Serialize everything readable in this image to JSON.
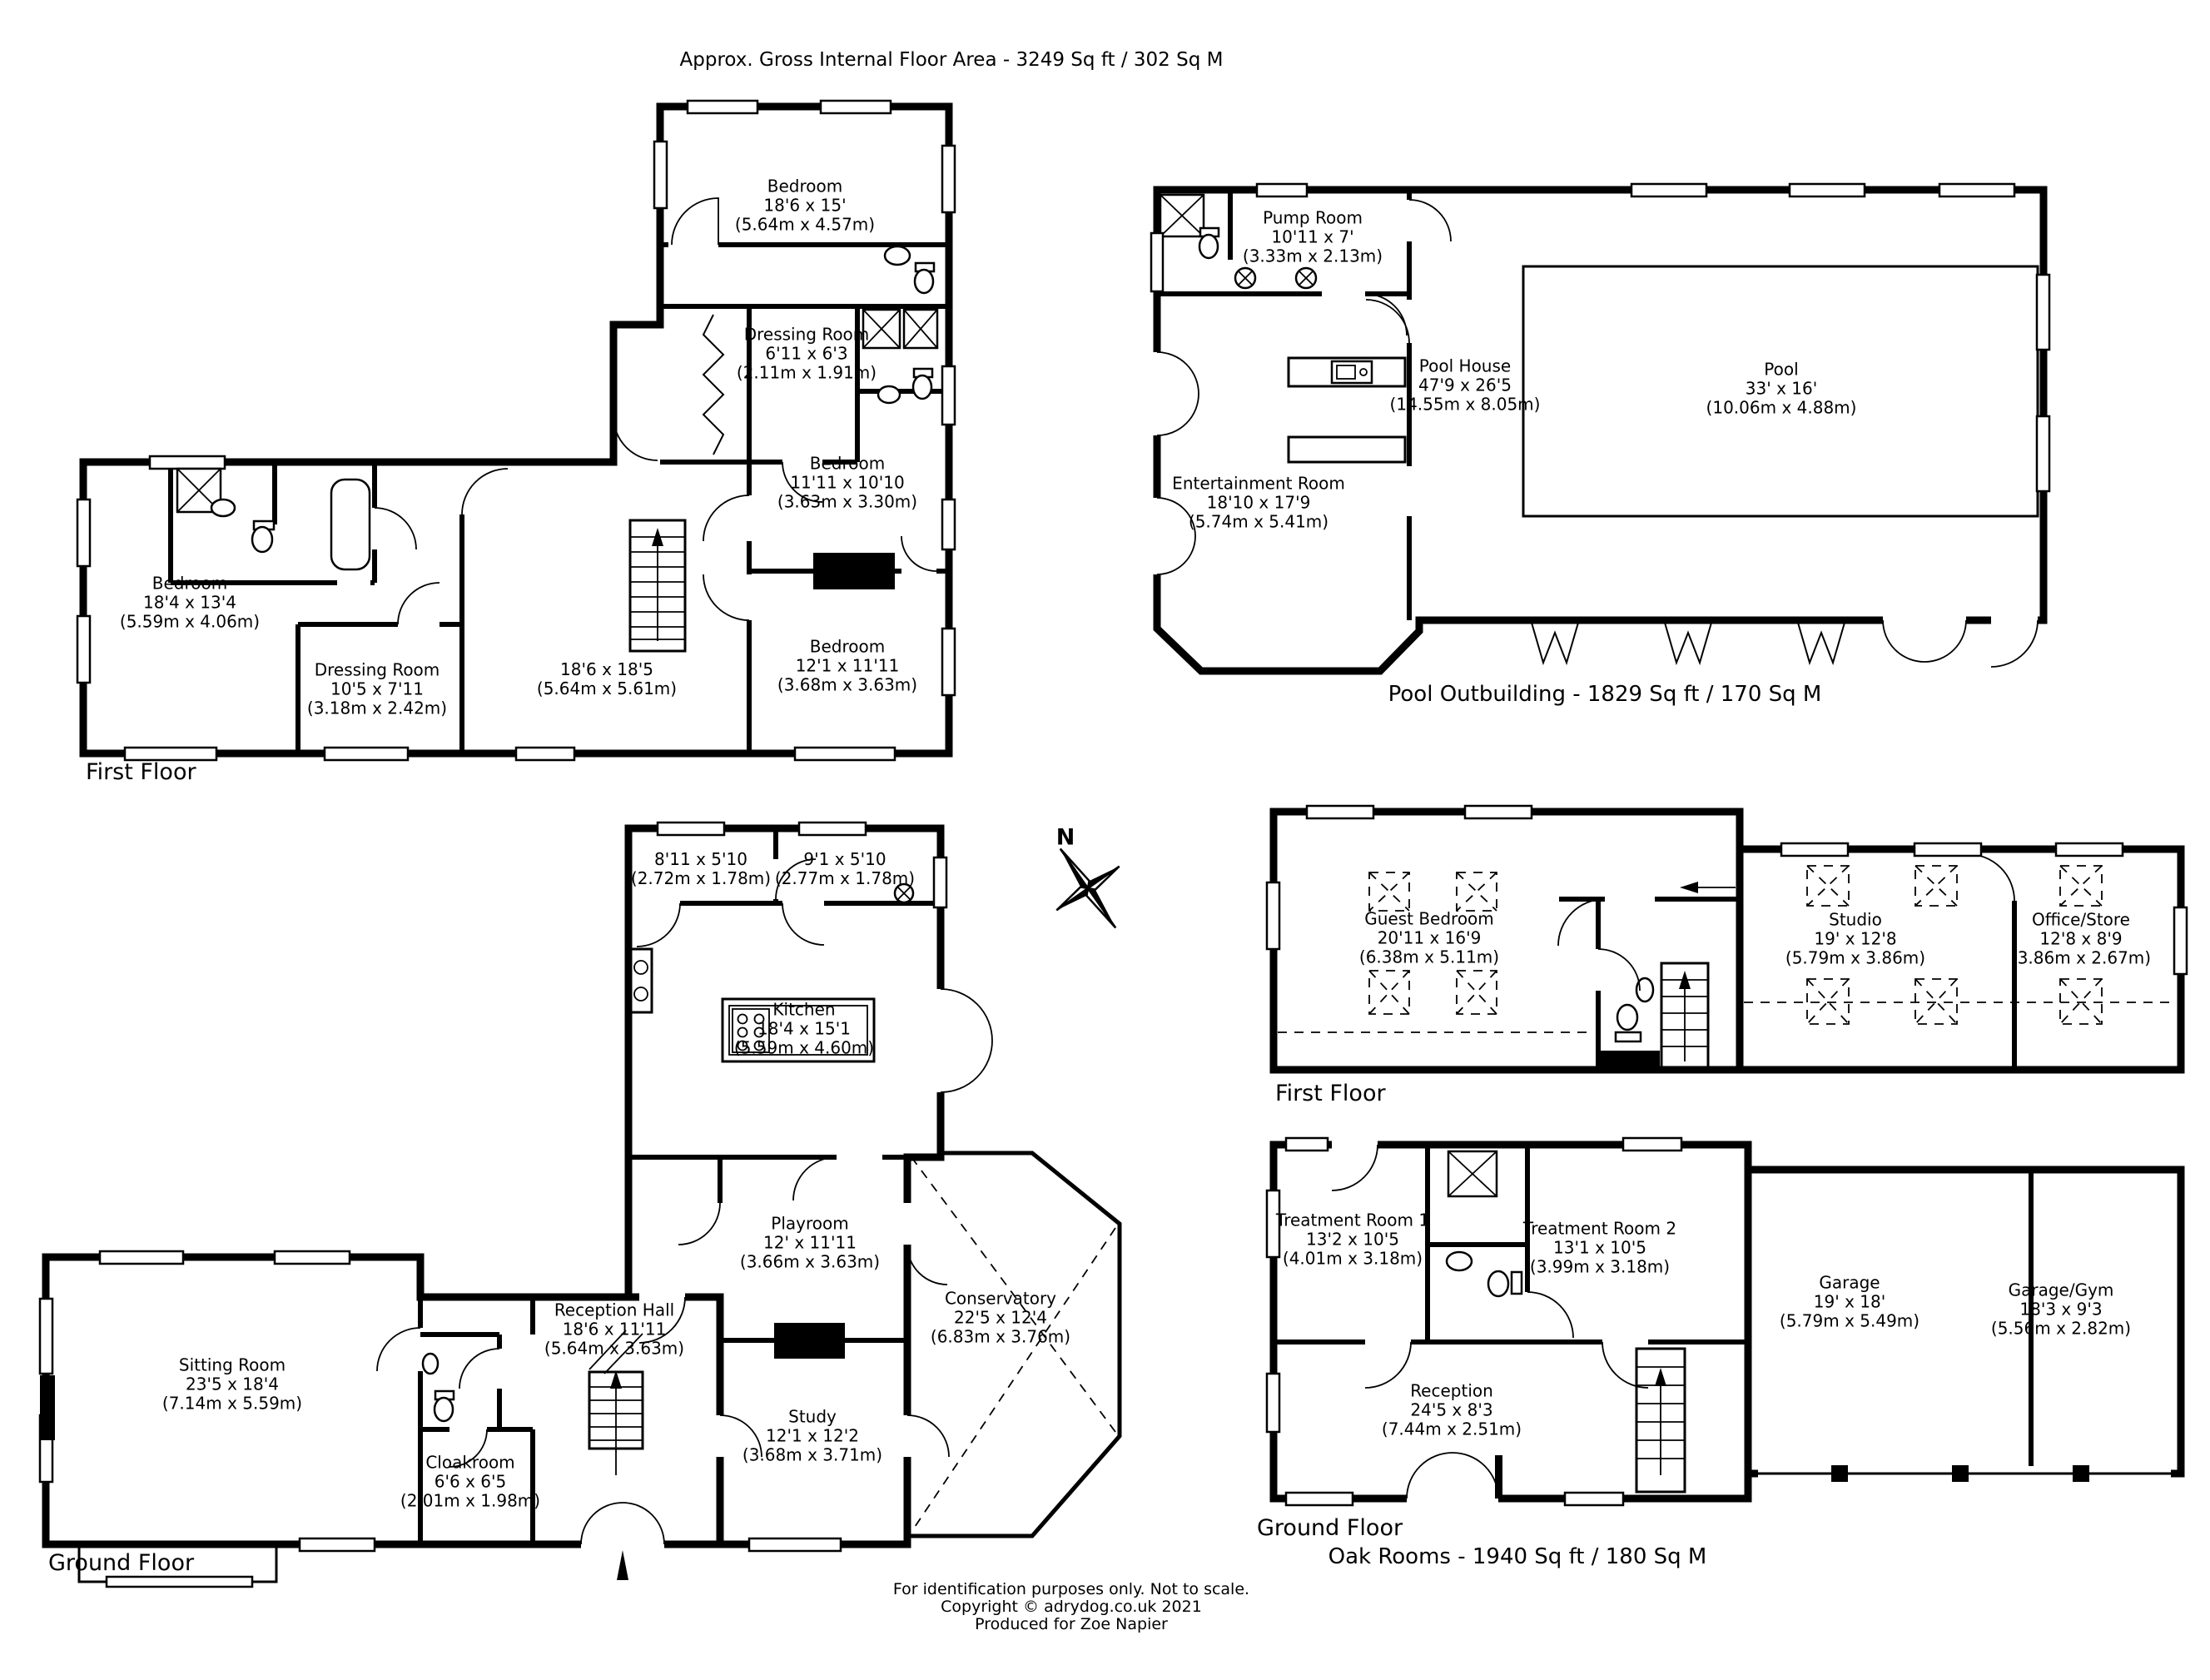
{
  "title": "Approx. Gross Internal Floor Area - 3249 Sq ft / 302 Sq M",
  "compass": {
    "north_label": "N"
  },
  "main_house": {
    "first_floor": {
      "floor_label": "First Floor",
      "rooms": [
        {
          "name": "Bedroom",
          "dims": "18'6 x 15'",
          "metric": "(5.64m x 4.57m)"
        },
        {
          "name": "Dressing Room",
          "dims": "6'11 x 6'3",
          "metric": "(2.11m x 1.91m)"
        },
        {
          "name": "Bedroom",
          "dims": "11'11 x 10'10",
          "metric": "(3.63m x 3.30m)"
        },
        {
          "name": "Bedroom",
          "dims": "18'4 x 13'4",
          "metric": "(5.59m x 4.06m)"
        },
        {
          "name": "Dressing Room",
          "dims": "10'5 x 7'11",
          "metric": "(3.18m x 2.42m)"
        },
        {
          "name": "",
          "dims": "18'6 x 18'5",
          "metric": "(5.64m x 5.61m)"
        },
        {
          "name": "Bedroom",
          "dims": "12'1 x 11'11",
          "metric": "(3.68m x 3.63m)"
        }
      ]
    },
    "ground_floor": {
      "floor_label": "Ground Floor",
      "rooms": [
        {
          "name": "",
          "dims": "8'11 x 5'10",
          "metric": "(2.72m x 1.78m)"
        },
        {
          "name": "",
          "dims": "9'1 x 5'10",
          "metric": "(2.77m x 1.78m)"
        },
        {
          "name": "Kitchen",
          "dims": "18'4 x 15'1",
          "metric": "(5.59m x 4.60m)"
        },
        {
          "name": "Playroom",
          "dims": "12' x 11'11",
          "metric": "(3.66m x 3.63m)"
        },
        {
          "name": "Conservatory",
          "dims": "22'5 x 12'4",
          "metric": "(6.83m x 3.76m)"
        },
        {
          "name": "Reception Hall",
          "dims": "18'6 x 11'11",
          "metric": "(5.64m x 3.63m)"
        },
        {
          "name": "Sitting Room",
          "dims": "23'5 x 18'4",
          "metric": "(7.14m x 5.59m)"
        },
        {
          "name": "Cloakroom",
          "dims": "6'6 x 6'5",
          "metric": "(2.01m x 1.98m)"
        },
        {
          "name": "Study",
          "dims": "12'1 x 12'2",
          "metric": "(3.68m x 3.71m)"
        }
      ]
    }
  },
  "pool_outbuilding": {
    "area_label": "Pool Outbuilding - 1829 Sq ft / 170 Sq M",
    "rooms": [
      {
        "name": "Pump Room",
        "dims": "10'11 x 7'",
        "metric": "(3.33m x 2.13m)"
      },
      {
        "name": "Pool House",
        "dims": "47'9 x 26'5",
        "metric": "(14.55m x 8.05m)"
      },
      {
        "name": "Pool",
        "dims": "33' x 16'",
        "metric": "(10.06m x 4.88m)"
      },
      {
        "name": "Entertainment Room",
        "dims": "18'10 x 17'9",
        "metric": "(5.74m x 5.41m)"
      }
    ]
  },
  "oak_rooms": {
    "area_label": "Oak Rooms - 1940 Sq ft / 180 Sq M",
    "first_floor": {
      "floor_label": "First Floor",
      "rooms": [
        {
          "name": "Guest Bedroom",
          "dims": "20'11 x 16'9",
          "metric": "(6.38m x 5.11m)"
        },
        {
          "name": "Studio",
          "dims": "19' x 12'8",
          "metric": "(5.79m x 3.86m)"
        },
        {
          "name": "Office/Store",
          "dims": "12'8 x 8'9",
          "metric": "(3.86m x 2.67m)"
        }
      ]
    },
    "ground_floor": {
      "floor_label": "Ground Floor",
      "rooms": [
        {
          "name": "Treatment Room 1",
          "dims": "13'2 x 10'5",
          "metric": "(4.01m x 3.18m)"
        },
        {
          "name": "Treatment Room 2",
          "dims": "13'1 x 10'5",
          "metric": "(3.99m x 3.18m)"
        },
        {
          "name": "Reception",
          "dims": "24'5 x 8'3",
          "metric": "(7.44m x 2.51m)"
        },
        {
          "name": "Garage",
          "dims": "19' x 18'",
          "metric": "(5.79m x 5.49m)"
        },
        {
          "name": "Garage/Gym",
          "dims": "18'3 x 9'3",
          "metric": "(5.56m x 2.82m)"
        }
      ]
    }
  },
  "footer": {
    "line1": "For identification purposes only. Not to scale.",
    "line2": "Copyright © adrydog.co.uk 2021",
    "line3": "Produced for Zoe Napier"
  }
}
